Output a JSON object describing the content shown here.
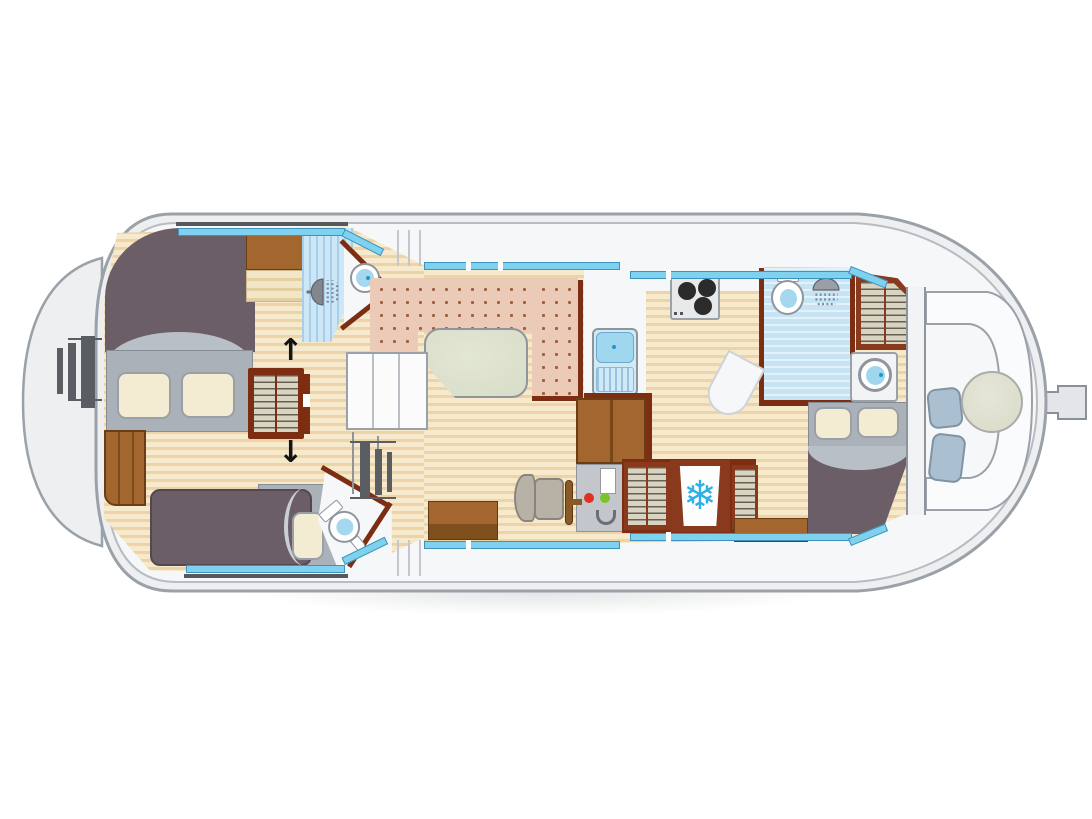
{
  "diagram": {
    "type": "boat-floor-plan",
    "style": "top-down canal boat deck plan, no text labels"
  },
  "icons": {
    "snowflake": "❄",
    "arrow_up": "↑",
    "arrow_down": "↓"
  },
  "colors": {
    "hull_fill": "#edeff1",
    "hull_stroke": "#9aa1a8",
    "hull_inner": "#b6bcc2",
    "deck": "#f6f7f8",
    "wall_dark": "#55585c",
    "wall_brown": "#7c2d12",
    "wood_light": "#f7e9cb",
    "wood_dark": "#ecd4a8",
    "carpet": "#ebcbb8",
    "carpet_dot": "#a05f3e",
    "window": "#7fd2ef",
    "tile_bow": "#cde7f7",
    "tile_aft": "#c7e4f5",
    "bed_dark": "#6b5e66",
    "bed_gray": "#aab1b9",
    "duvet_fold": "#b9bfc7",
    "pillow": "#f3ecd2",
    "pillow_edge": "#9aa0a8",
    "brown": "#a4662f",
    "brown_dark": "#6b3d14",
    "hatch_bg": "#d9d4c2",
    "cushion": "#aabfd0",
    "cushion_edge": "#7f93a5",
    "table_salon": "#d8ddc8",
    "table_aft": "#dcdccb",
    "console": "#c3c7cc",
    "console_dark": "#8e949a",
    "seat_tan": "#b7b1a6",
    "red_light": "#e03020",
    "green_light": "#7ac32a",
    "water": "#a5d8ef",
    "sink_blue": "#9fd8ee",
    "blue_dot": "#2196c9",
    "snow": "#2bb0e8",
    "steel": "#5a5d61",
    "arrow": "#141414"
  }
}
